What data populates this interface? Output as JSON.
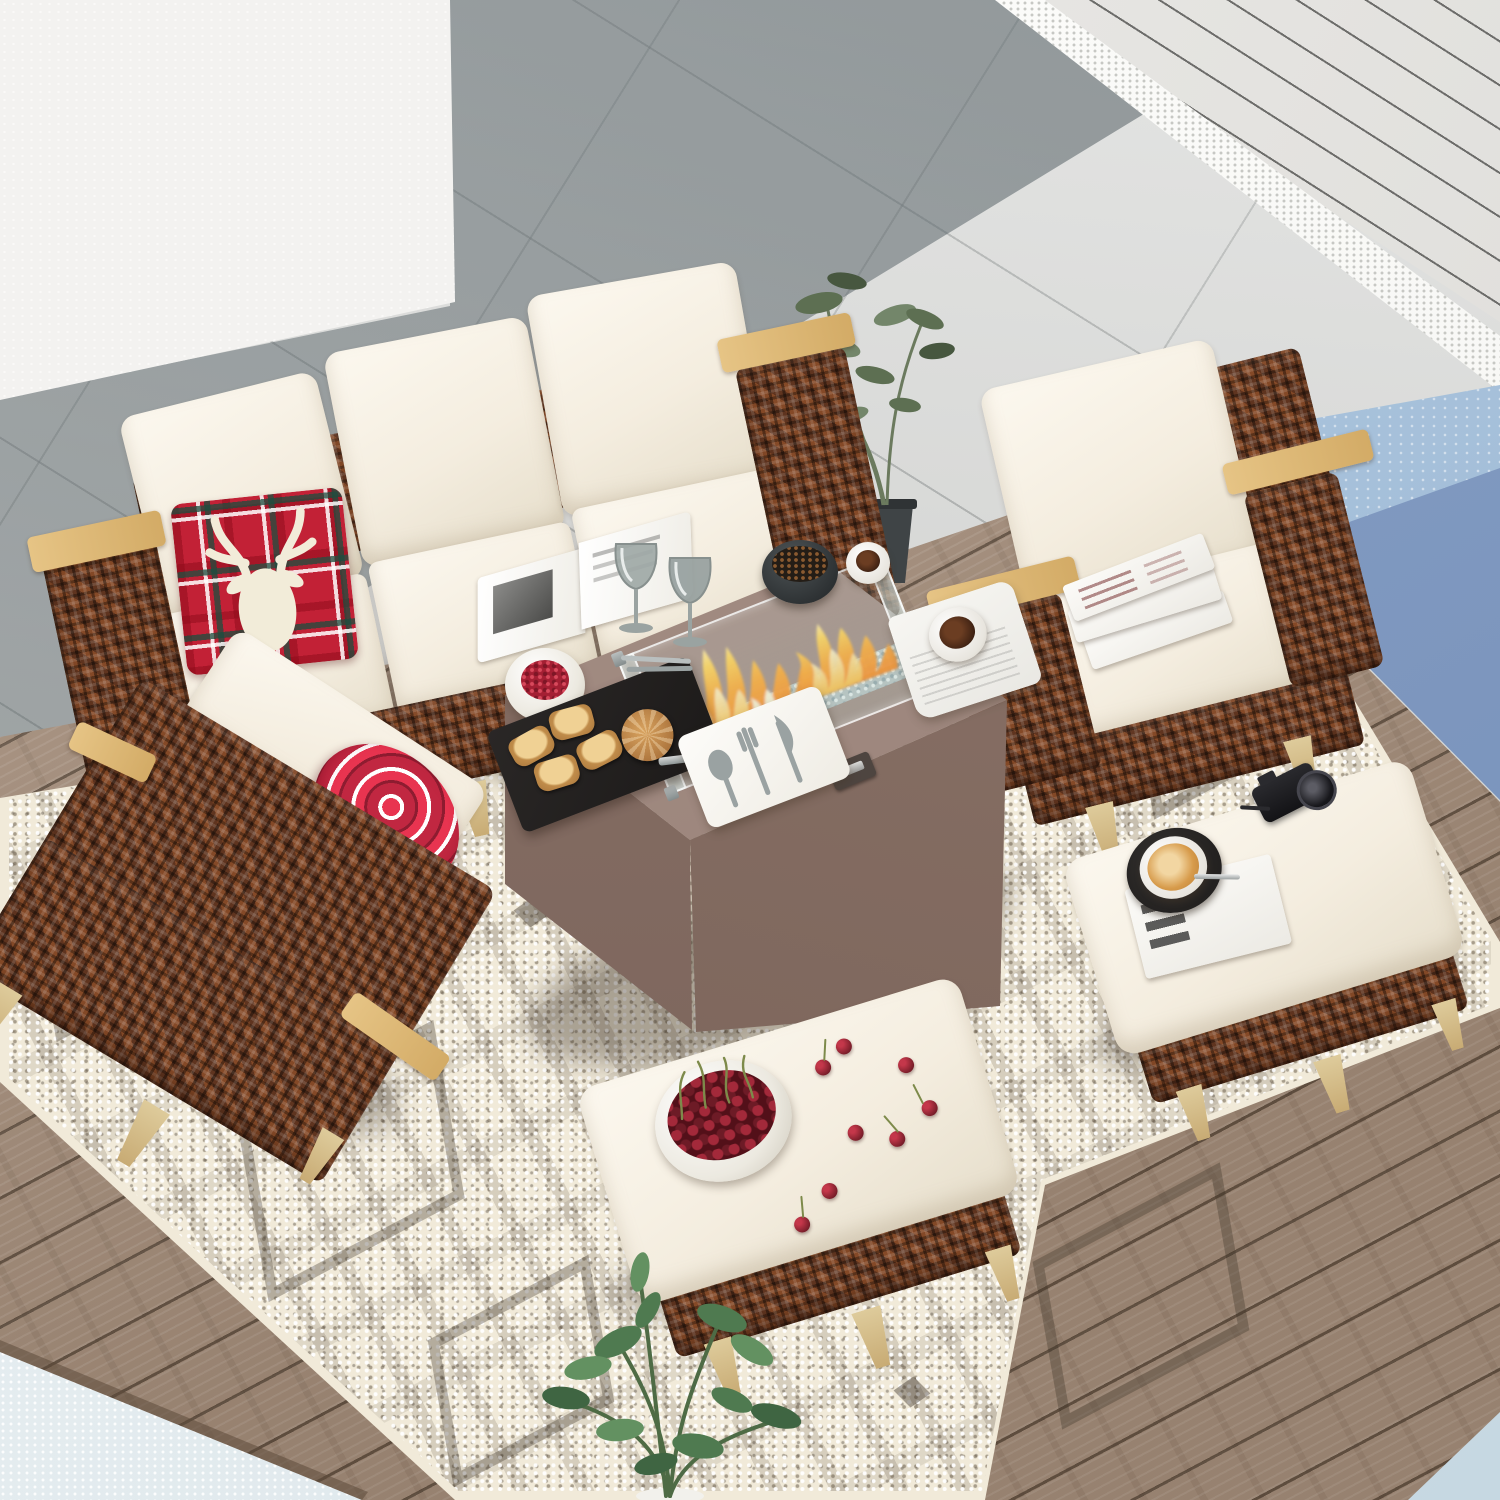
{
  "scene": {
    "aria": {
      "scene": "Outdoor wicker patio lounge set with fire pit table on a deck beside a pool",
      "wall": "White stucco wall",
      "slat_wall": "White slatted privacy wall",
      "stone_patio": "Gray stone tile patio",
      "patio_shadow": "Shadowed area of stone patio",
      "gravel_strip": "White gravel strip at wall base",
      "pool": "Blue swimming pool water",
      "deck": "Weathered wood plank deck",
      "water_edge": "Pale water at deck edge",
      "rug": "Cream chunky-knit area rug with dark geometric motifs",
      "sofa": "Three-seat brown wicker sofa with cream cushions",
      "sofa_pillow": "Red tartan plaid pillow with cream reindeer",
      "sofa_book": "Open book lying on sofa seat",
      "armchair_right": "Brown wicker armchair with cream cushions and stacked magazines",
      "armchair_left": "Brown wicker armchair seen from behind with red striped pillow",
      "fire_table": "Taupe propane fire pit table",
      "wind_guard": "Glass wind guard with burning flames over fire glass",
      "berry_bowl": "White bowl of red berries",
      "slate_tray": "Black slate tray with toasted bread and tongs",
      "serving_board": "White serving board with spoon, fork and knife",
      "bean_bowl": "Dark bowl of coffee beans",
      "white_cup": "White espresso cup",
      "newspaper": "Newspaper with a cup of coffee",
      "wine_glasses": "Two gray wine glasses",
      "ottoman_cherries": "Wicker ottoman with a bowl of cherries",
      "ottoman_latte": "Wicker ottoman with latte, magazine and camera",
      "potted_plant": "Wispy potted plant in dark planter",
      "foreground_plant": "Leafy green plant in the foreground"
    },
    "colors": {
      "tile": "#d8d9d7",
      "wallc": "#f0efed",
      "slat": "#e9e7e4",
      "gravelc": "#f7f7f4",
      "poolc": "#a9c3dc",
      "poolDark": "#7e96bd",
      "deck": "#a8917e",
      "deckGap": "#63503f",
      "rug": "#f1ead9",
      "rugDark": "#4a4036",
      "wicker": "#5f341f",
      "wickerLight": "#a65f33",
      "wood": "#d9b36c",
      "legc": "#d9be8c",
      "cushion": "#f7f2e7",
      "tableTop": "#a18b81",
      "tableFront": "#846d62",
      "flame": "#ff9a1f",
      "flameCore": "#ffe9a8",
      "plaid": "#c22136",
      "cherryc": "#7c1f2b",
      "glassc": "#cfe0da",
      "slatec": "#23211f",
      "lattec": "#d79b4b",
      "plantc": "#55704e",
      "water": "#e8eef1"
    }
  }
}
